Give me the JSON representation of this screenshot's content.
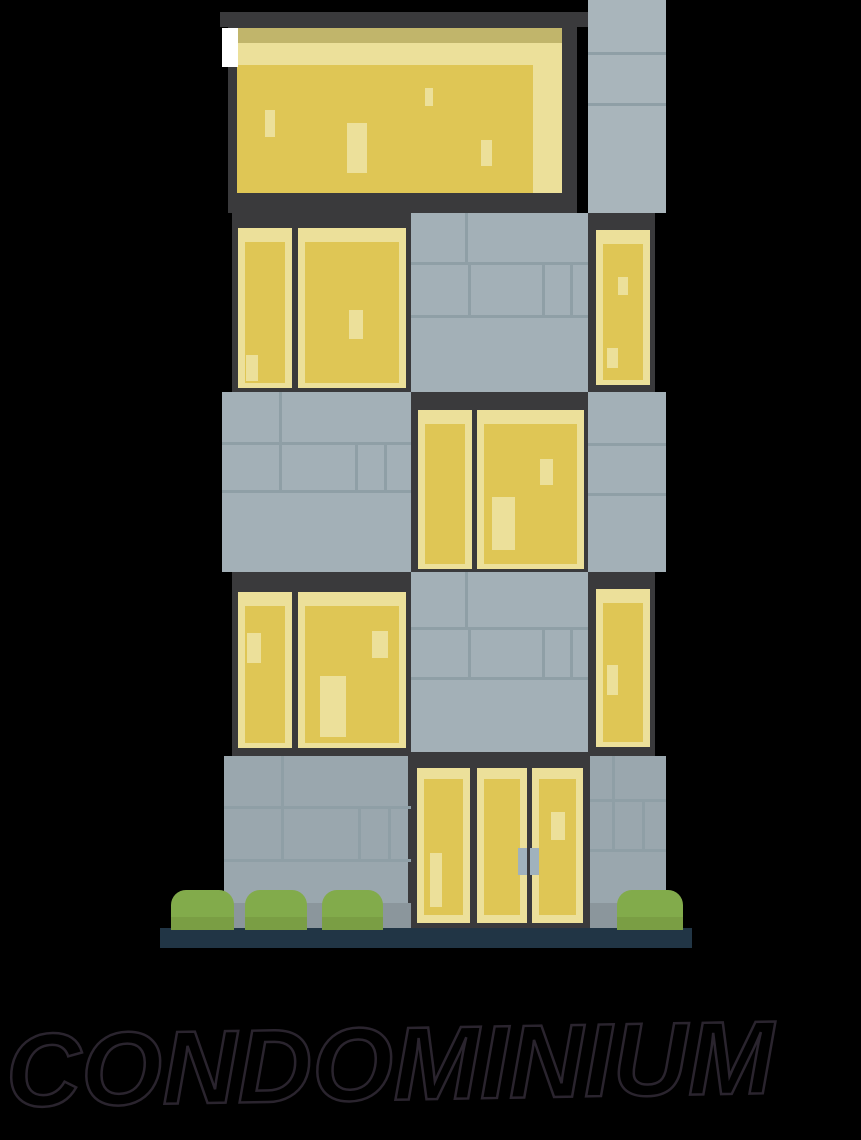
{
  "caption": {
    "text": "CONDOMINIUM"
  },
  "illustration": {
    "subject": "flat-design condominium building at night",
    "floors": 5,
    "window_count": 10,
    "door_panel_count": 3,
    "bush_count": 4,
    "colors": {
      "background": "#000000",
      "frame_dark": "#3a3a3c",
      "window_yellow": "#dfc655",
      "window_yellow_light": "#ece09a",
      "window_olive_band": "#c1b56b",
      "wall_gray": "#a3b0b7",
      "wall_gray_light": "#a9b5bb",
      "wall_gray_ground": "#9aa7ae",
      "wall_gray_ground_shade": "#8b969c",
      "mortar_gray": "#8f9fa6",
      "bush_green": "#82ab4b",
      "bush_green_dark": "#7a9e44",
      "base_navy": "#213545",
      "door_handle_gray": "#a0b2bd",
      "highlight_white": "#ffffff",
      "caption_outline": "#2a242e"
    }
  }
}
